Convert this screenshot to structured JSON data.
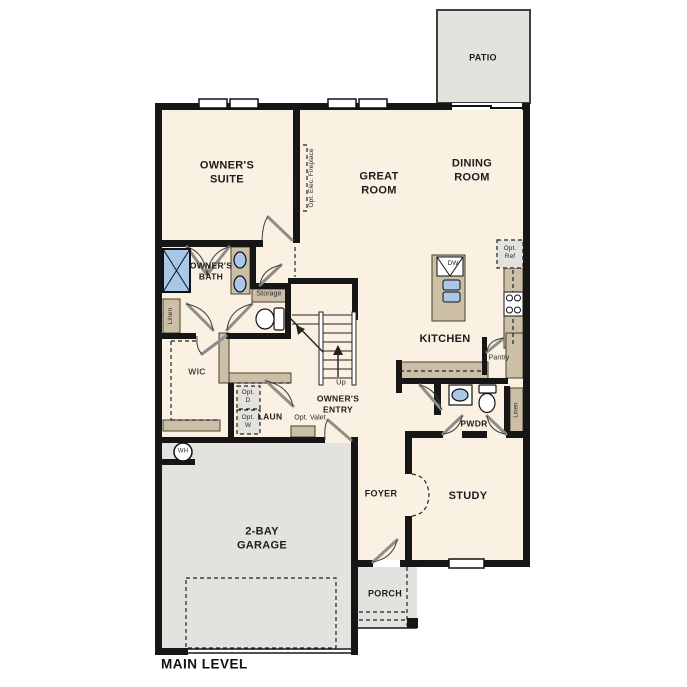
{
  "plan_title": "MAIN LEVEL",
  "colors": {
    "room_fill": "#FAF1E3",
    "outdoor_fill": "#E3E2DF",
    "cabinet_tan": "#CDBFA7",
    "fixture_blue": "#A9C7E8",
    "wall_black": "#161616"
  },
  "rooms": {
    "patio": "PATIO",
    "owners_suite": "OWNER'S\nSUITE",
    "great_room": "GREAT\nROOM",
    "dining_room": "DINING\nROOM",
    "owners_bath": "OWNER'S\nBATH",
    "wic": "WIC",
    "owners_entry": "OWNER'S\nENTRY",
    "laundry": "LAUN",
    "kitchen": "KITCHEN",
    "pantry": "Pantry",
    "powder": "PWDR",
    "garage": "2-BAY\nGARAGE",
    "foyer": "FOYER",
    "study": "STUDY",
    "porch": "PORCH"
  },
  "annotations": {
    "fireplace": "Opt. Elec. Fireplace",
    "storage": "Storage",
    "linen_left": "Linen",
    "linen_right": "Linen",
    "up": "Up",
    "opt_valet": "Opt. Valet",
    "opt_dryer": "Opt.\nD",
    "opt_washer": "Opt.\nW",
    "dishwasher": "DW",
    "opt_refrigerator": "Opt.\nRef",
    "water_heater": "WH"
  }
}
